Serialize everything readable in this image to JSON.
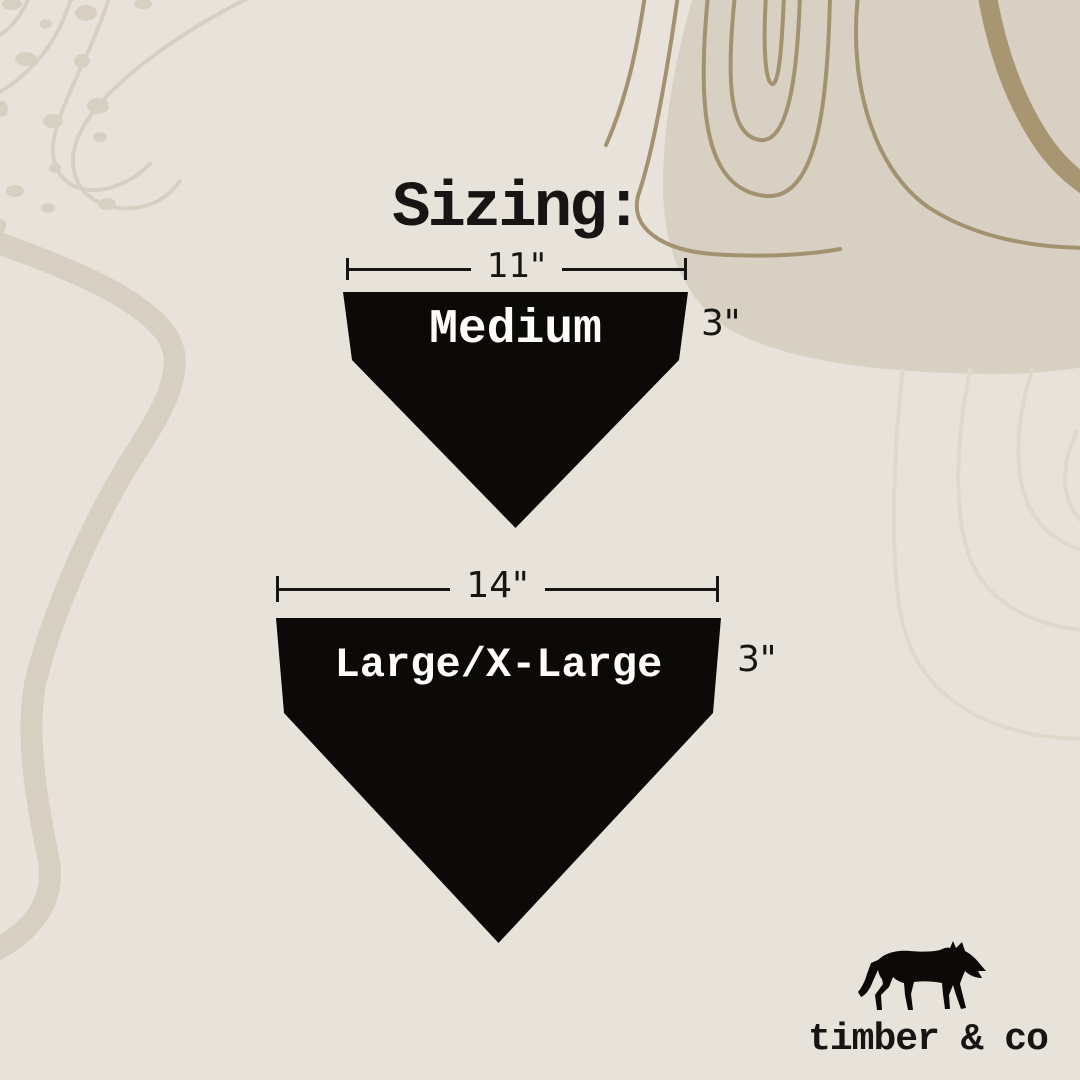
{
  "title": "Sizing:",
  "sizes": [
    {
      "name": "Medium",
      "width": "11\"",
      "height": "3\""
    },
    {
      "name": "Large/X-Large",
      "width": "14\"",
      "height": "3\""
    }
  ],
  "brand": {
    "name": "timber & co",
    "logo": "wolf-silhouette"
  },
  "colors": {
    "background": "#E8E3DA",
    "blob": "#D7D0C3",
    "deco_light": "#D7D0C2",
    "deco_faint": "#DFD9CC",
    "deco_dark": "#A39270",
    "band_dark": "#A89673",
    "bandana": "#0B0A08",
    "label_text": "#FFFDF8",
    "dimension": "#161513"
  }
}
